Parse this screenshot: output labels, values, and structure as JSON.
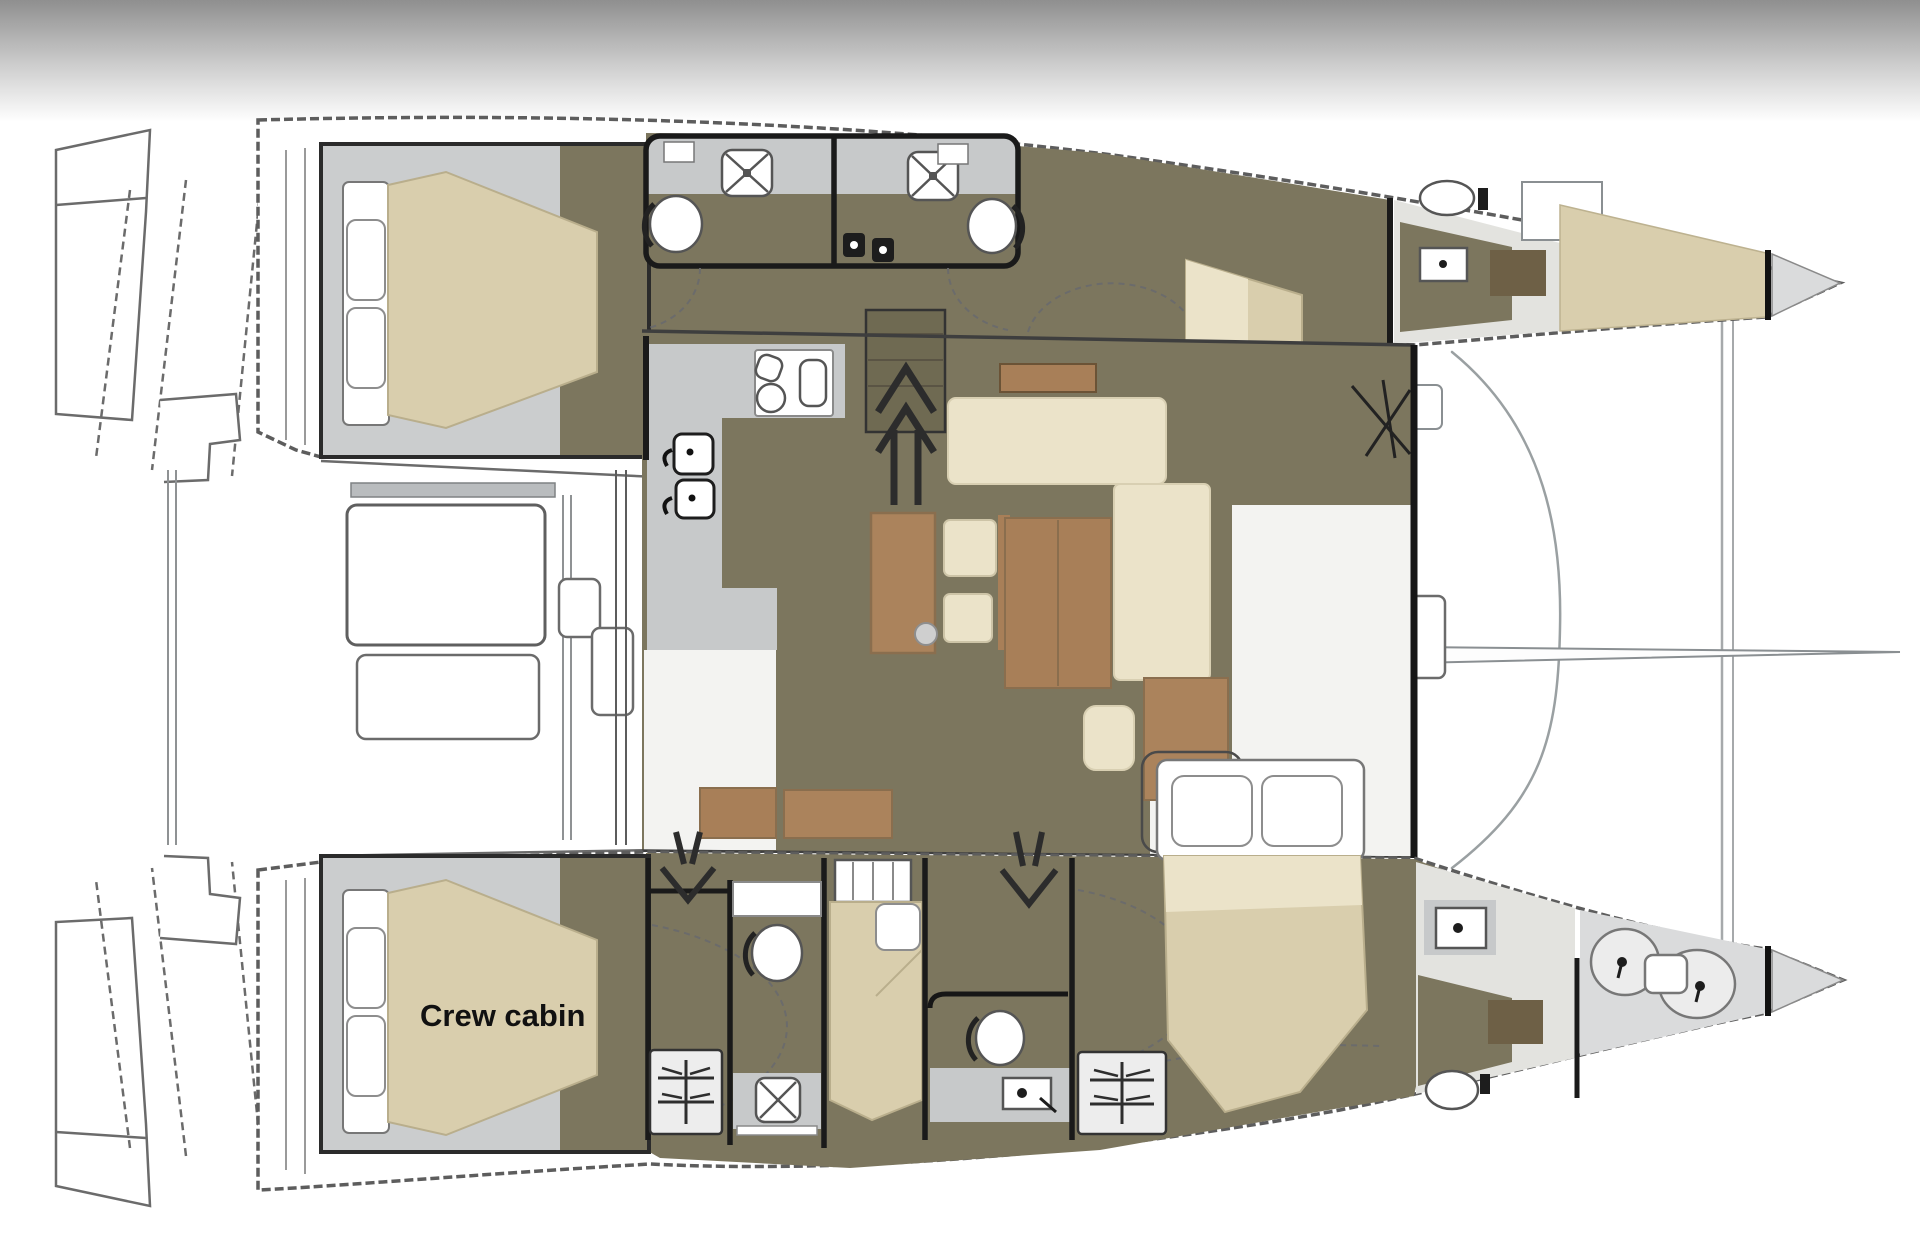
{
  "page": {
    "background": "#ffffff",
    "top_bar": {
      "gradient_top": "#8f8f8f",
      "gradient_bottom": "#ffffff"
    }
  },
  "plan": {
    "labels": {
      "crew_cabin": "Crew cabin"
    },
    "colors": {
      "floor_olive": "#7c765e",
      "floor_gray": "#c7c9ca",
      "cabin_surround_gray": "#cbcdce",
      "mattress_tan": "#d9cead",
      "cushion_cream": "#ebe3c9",
      "wood_brown": "#ab835c",
      "wood_brown_dark": "#8a6e4e",
      "rug_dark": "#6e6046",
      "wall_black": "#1a1a1a",
      "hull_outline": "#5d5d5d",
      "forepeak_gray": "#dadbdc"
    },
    "icons": [
      "shower-icon",
      "toilet-icon",
      "sink-icon",
      "faucet-icon",
      "stove-icon",
      "vent-grille-icon",
      "stairs-up-arrow-icon",
      "stairs-down-arrow-icon",
      "anchor-gear-icon"
    ],
    "rooms": [
      "aft-cabin-port",
      "head-port-aft",
      "head-port-fwd",
      "fwd-cabin-port",
      "bow-head-port",
      "v-berth-port",
      "salon",
      "galley",
      "dinette",
      "cockpit",
      "foredeck",
      "crew-cabin",
      "head-stbd-aft",
      "mid-cabin-stbd",
      "head-stbd-fwd",
      "fwd-cabin-stbd",
      "bow-head-stbd",
      "forepeak-stbd"
    ]
  }
}
